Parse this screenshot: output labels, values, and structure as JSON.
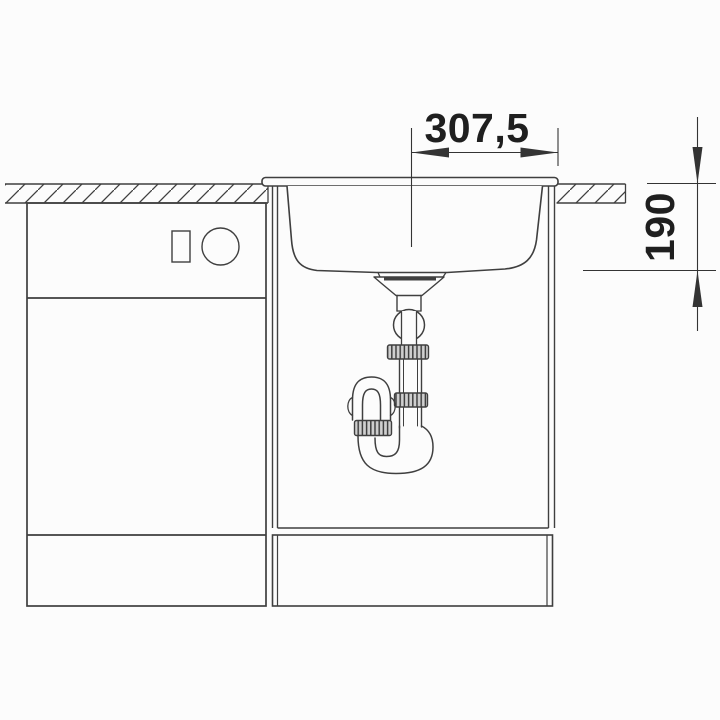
{
  "drawing": {
    "kind": "sink-installation-side-view",
    "colors": {
      "background": "#fcfcfc",
      "line": "#3f3f3f",
      "dim_line": "#343434",
      "label": "#1f1f1f",
      "nut_fill": "#cfcfcf"
    }
  },
  "labels": {
    "width_dim": "307,5",
    "depth_dim": "190"
  }
}
